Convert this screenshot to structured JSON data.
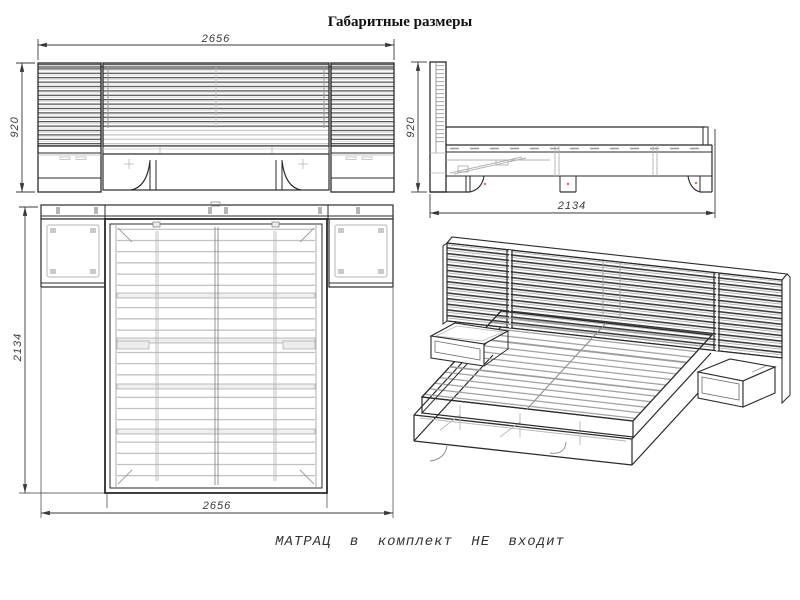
{
  "title": "Габаритные размеры",
  "note": "МАТРАЦ в комплект НЕ входит",
  "dimensions": {
    "front": {
      "width": "2656",
      "height": "920"
    },
    "side": {
      "height": "920",
      "depth": "2134"
    },
    "top": {
      "depth": "2134",
      "width": "2656"
    }
  },
  "colors": {
    "ink": "#2b2b2b",
    "mid_line": "#8a8a8a",
    "light_line": "#b5b5b5",
    "accent_red": "#cc6f6f",
    "background": "#ffffff"
  }
}
